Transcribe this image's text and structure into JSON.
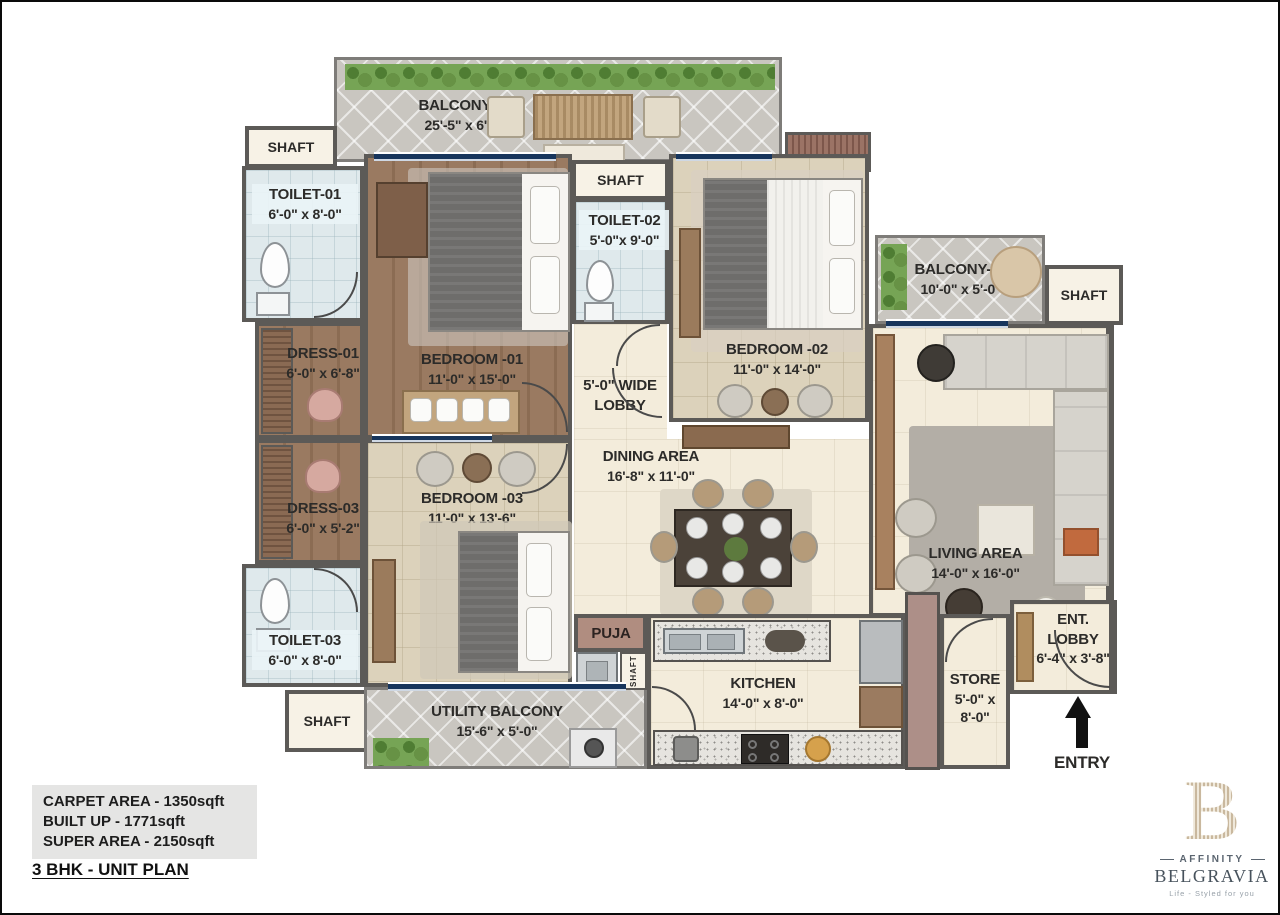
{
  "rooms": {
    "balcony01": {
      "name": "BALCONY-01",
      "dims": "25'-5\" x 6'-0\""
    },
    "shaft_top_left": {
      "name": "SHAFT"
    },
    "toilet01": {
      "name": "TOILET-01",
      "dims": "6'-0\" x 8'-0\""
    },
    "dress01": {
      "name": "DRESS-01",
      "dims": "6'-0\" x 6'-8\""
    },
    "bedroom01": {
      "name": "BEDROOM -01",
      "dims": "11'-0\" x 15'-0\""
    },
    "shaft_top_center": {
      "name": "SHAFT"
    },
    "toilet02": {
      "name": "TOILET-02",
      "dims": "5'-0\"x 9'-0\""
    },
    "bedroom02": {
      "name": "BEDROOM -02",
      "dims": "11'-0\" x 14'-0\""
    },
    "balcony02": {
      "name": "BALCONY-02",
      "dims": "10'-0\" x 5'-0\""
    },
    "shaft_right": {
      "name": "SHAFT"
    },
    "lobby": {
      "name": "5'-0\" WIDE",
      "name2": "LOBBY"
    },
    "dining": {
      "name": "DINING AREA",
      "dims": "16'-8\" x 11'-0\""
    },
    "dress03": {
      "name": "DRESS-03",
      "dims": "6'-0\" x 5'-2\""
    },
    "bedroom03": {
      "name": "BEDROOM -03",
      "dims": "11'-0\" x 13'-6\""
    },
    "toilet03": {
      "name": "TOILET-03",
      "dims": "6'-0\" x 8'-0\""
    },
    "living": {
      "name": "LIVING AREA",
      "dims": "14'-0\" x 16'-0\""
    },
    "ent_lobby": {
      "name": "ENT. LOBBY",
      "dims": "6'-4\" x 3'-8\""
    },
    "shaft_bottom_left": {
      "name": "SHAFT"
    },
    "utility": {
      "name": "UTILITY BALCONY",
      "dims": "15'-6\" x 5'-0\""
    },
    "puja": {
      "name": "PUJA"
    },
    "shaft_kitchen": {
      "name": "SHAFT"
    },
    "kitchen": {
      "name": "KITCHEN",
      "dims": "14'-0\" x 8'-0\""
    },
    "store": {
      "name": "STORE",
      "dims": "5'-0\" x 8'-0\""
    },
    "entry": {
      "name": "ENTRY"
    }
  },
  "info": {
    "carpet": "CARPET AREA - 1350sqft",
    "built_up": "BUILT UP - 1771sqft",
    "super_area": "SUPER AREA - 2150sqft",
    "plan_title": "3 BHK - UNIT PLAN"
  },
  "brand": {
    "monogram": "B",
    "name_top": "AFFINITY",
    "name_main": "BELGRAVIA",
    "tagline": "Life - Styled for you"
  },
  "colors": {
    "wall": "#5c5a57",
    "wood_floor": "#9a7a61",
    "beige_tile": "#dcd2bb",
    "cream_floor": "#f3ecdb",
    "balcony_tile": "#c9c6c0",
    "bath_tile": "#dfe9ec",
    "window_navy": "#17355c",
    "hedge_green": "#76a455",
    "brand_tan": "#c9b89e",
    "brand_text": "#47525c"
  }
}
